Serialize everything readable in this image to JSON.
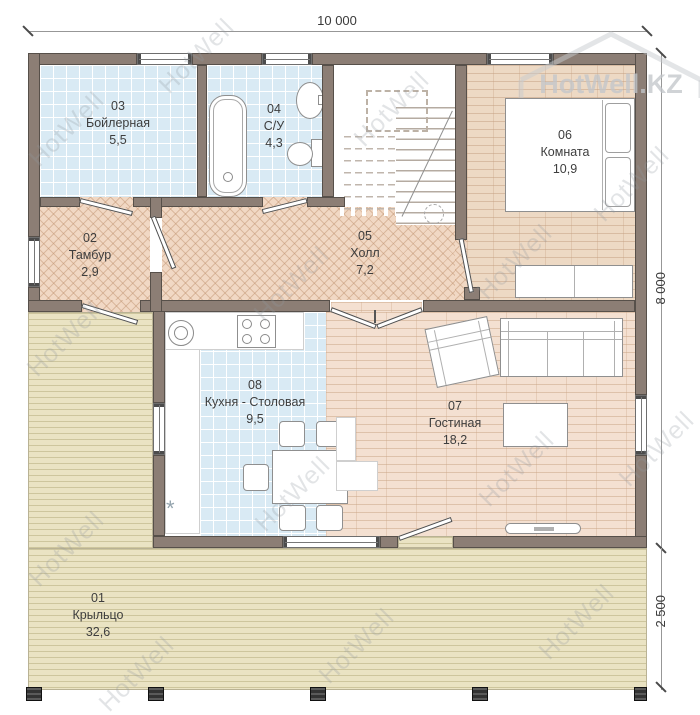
{
  "plan": {
    "dims": {
      "width_top": "10 000",
      "height_right": "8 000",
      "porch_right": "2 500"
    },
    "watermark": {
      "tile": "HotWell",
      "brand": "HotWell.KZ"
    },
    "rooms": [
      {
        "num": "01",
        "name": "Крыльцо",
        "area": "32,6"
      },
      {
        "num": "02",
        "name": "Тамбур",
        "area": "2,9"
      },
      {
        "num": "03",
        "name": "Бойлерная",
        "area": "5,5"
      },
      {
        "num": "04",
        "name": "С/У",
        "area": "4,3"
      },
      {
        "num": "05",
        "name": "Холл",
        "area": "7,2"
      },
      {
        "num": "06",
        "name": "Комната",
        "area": "10,9"
      },
      {
        "num": "07",
        "name": "Гостиная",
        "area": "18,2"
      },
      {
        "num": "08",
        "name": "Кухня - Столовая",
        "area": "9,5"
      }
    ],
    "symbols": {
      "kitchen_asterisk": "*"
    },
    "colors": {
      "wall": "#8c7e75",
      "tile_floor": "#d9eaf4",
      "herringbone_floor": "#f1d8c4",
      "bedroom_floor": "#edd9c4",
      "living_floor": "#f4e0d1",
      "porch_floor": "#eae3c3"
    }
  }
}
